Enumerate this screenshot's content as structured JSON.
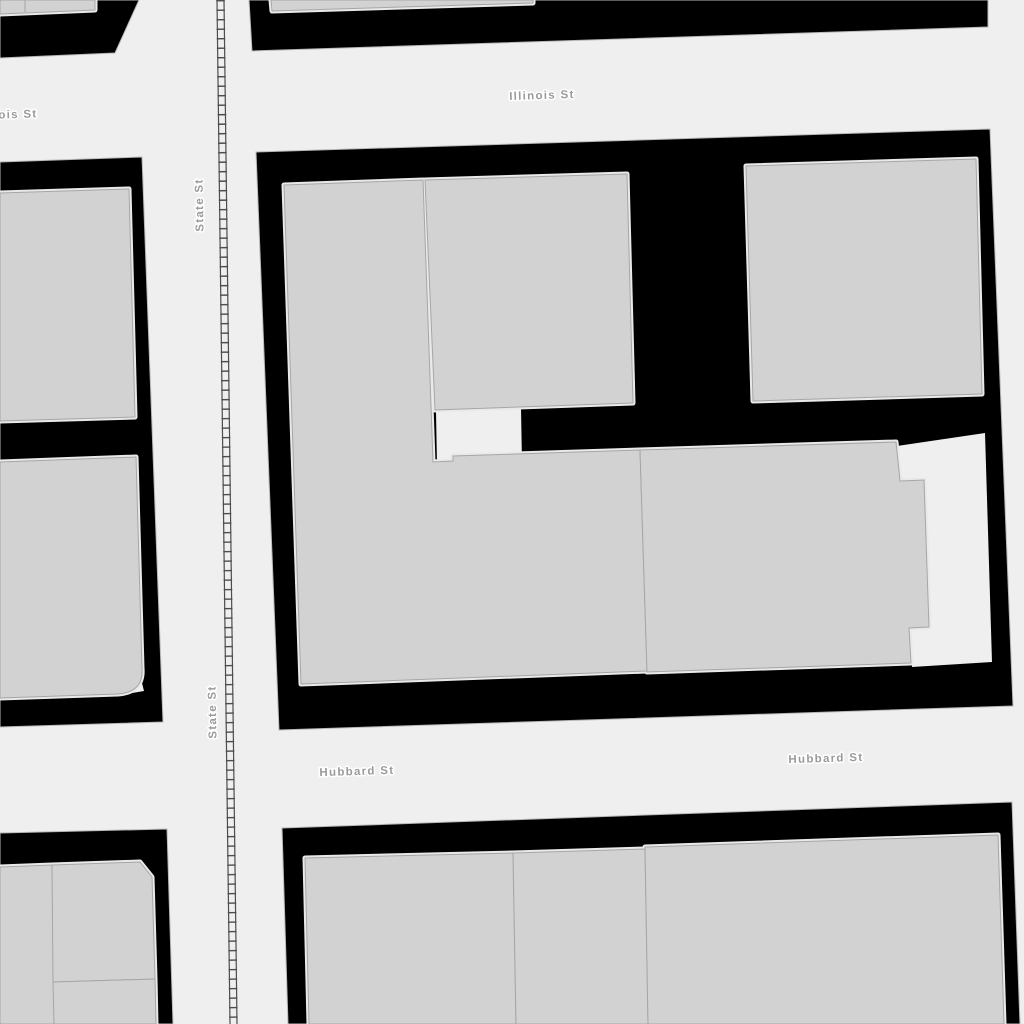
{
  "map": {
    "title": "Downtown street map detail",
    "labels": {
      "illinois": "Illinois St",
      "illinois_clipped": "ois St",
      "state_upper": "State St",
      "state_lower": "State St",
      "hubbard_west": "Hubbard St",
      "hubbard_east": "Hubbard St"
    },
    "colors": {
      "street": "#efefef",
      "block": "#000000",
      "block_outline": "#b8b8b8",
      "building_fill": "#d2d2d2",
      "building_stroke": "#a6a6a6",
      "parcel_halo": "#e9e9e9",
      "railway": "#4d4d4d",
      "label_text": "#9a9a9a",
      "label_halo": "#ffffff"
    }
  }
}
